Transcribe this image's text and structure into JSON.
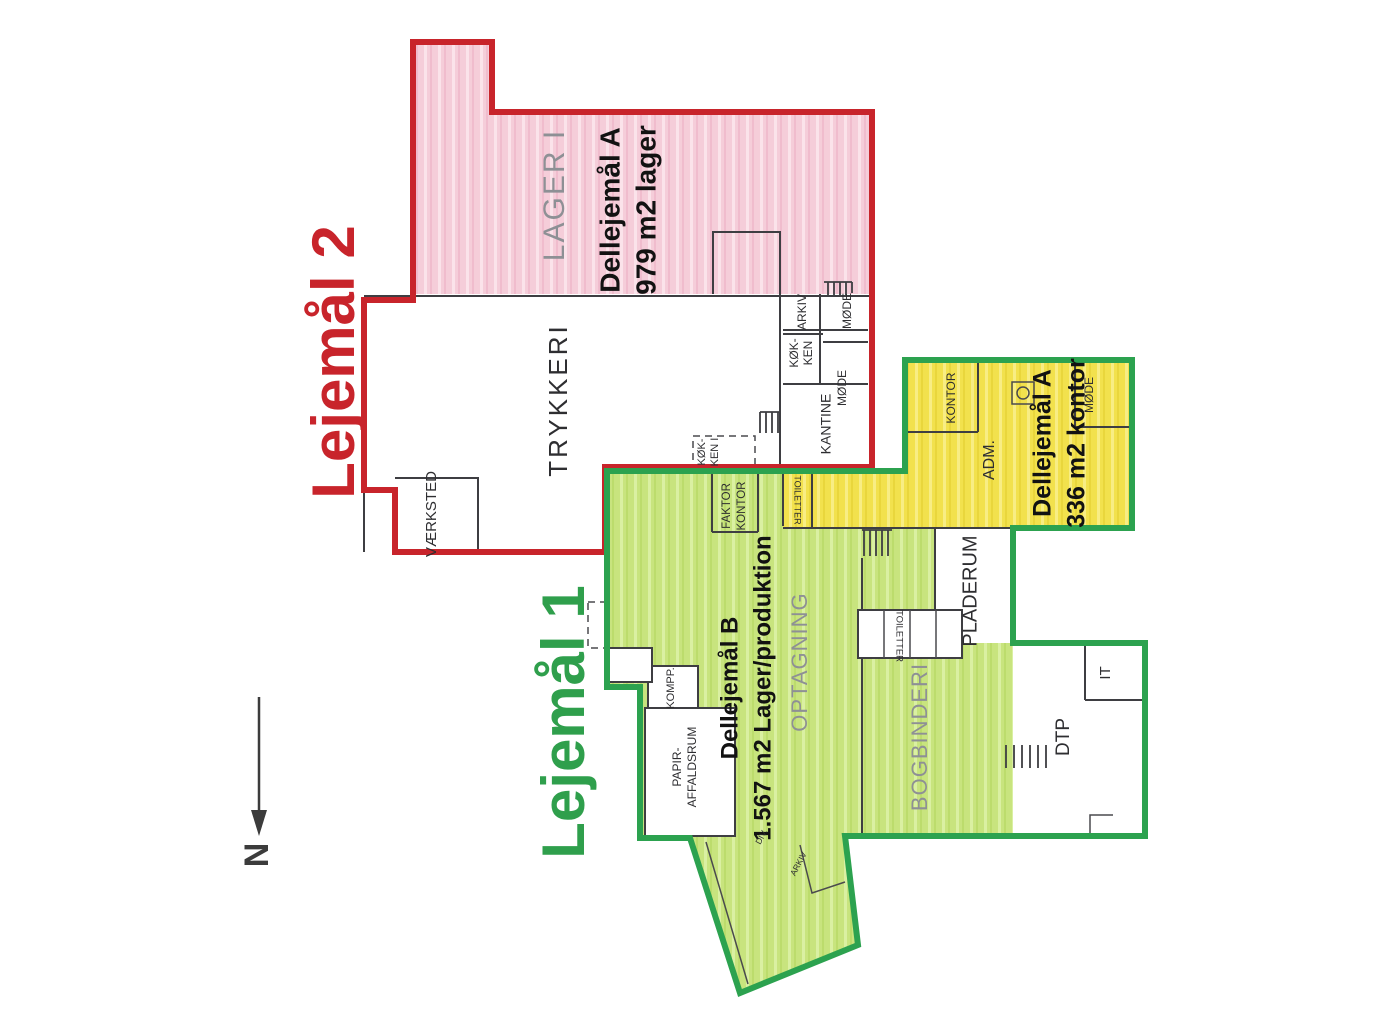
{
  "document": {
    "type": "floor-plan",
    "language": "da"
  },
  "colors": {
    "lease2_outline": "#c8242b",
    "lease1_outline": "#2ca24f",
    "lager_fill": "#f5cdd9",
    "production_fill": "#c8e47e",
    "office_fill": "#f2e14d",
    "wall": "#3e3e42",
    "muted_label": "#8e9095"
  },
  "leases": {
    "lejemaal2": {
      "title": "Lejemål 2",
      "area_label": "LAGER I",
      "dellejemaal_a": {
        "line1": "Dellejemål A",
        "line2": "979 m2 lager"
      }
    },
    "lejemaal1": {
      "title": "Lejemål 1",
      "dellejemaal_a": {
        "line1": "Dellejemål A",
        "line2": "336 m2 kontor"
      },
      "dellejemaal_b": {
        "line1": "Dellejemål B",
        "line2": "1.567 m2 Lager/produktion"
      }
    }
  },
  "rooms": {
    "trykkeri": "TRYKKERI",
    "vaerksted": "VÆRKSTED",
    "koekken": {
      "line1": "KØK-",
      "line2": "KEN"
    },
    "arkiv": "ARKIV",
    "moede_top": "MØDE",
    "moede_mid": "MØDE",
    "kantine": "KANTINE",
    "koekken_i": {
      "line1": "KØK-",
      "line2": "KEN I"
    },
    "faktor_kontor": {
      "line1": "FAKTOR",
      "line2": "KONTOR"
    },
    "toiletter_adm": "TOILETTER",
    "kontor": "KONTOR",
    "adm": "ADM.",
    "moede_adm": "MØDE",
    "optagning": "OPTAGNING",
    "bogbinderi": "BOGBINDERI",
    "pladerum": "PLADERUM",
    "toiletter_prod": "TOILETTER",
    "kompressor": "KOMPP.",
    "papir_affald": {
      "line1": "PAPIR-",
      "line2": "AFFALDSRUM"
    },
    "dtp": "DTP",
    "it": "IT",
    "div_small": "DIV.",
    "arkiv_small": "ARKIV"
  },
  "compass": {
    "label": "N"
  }
}
